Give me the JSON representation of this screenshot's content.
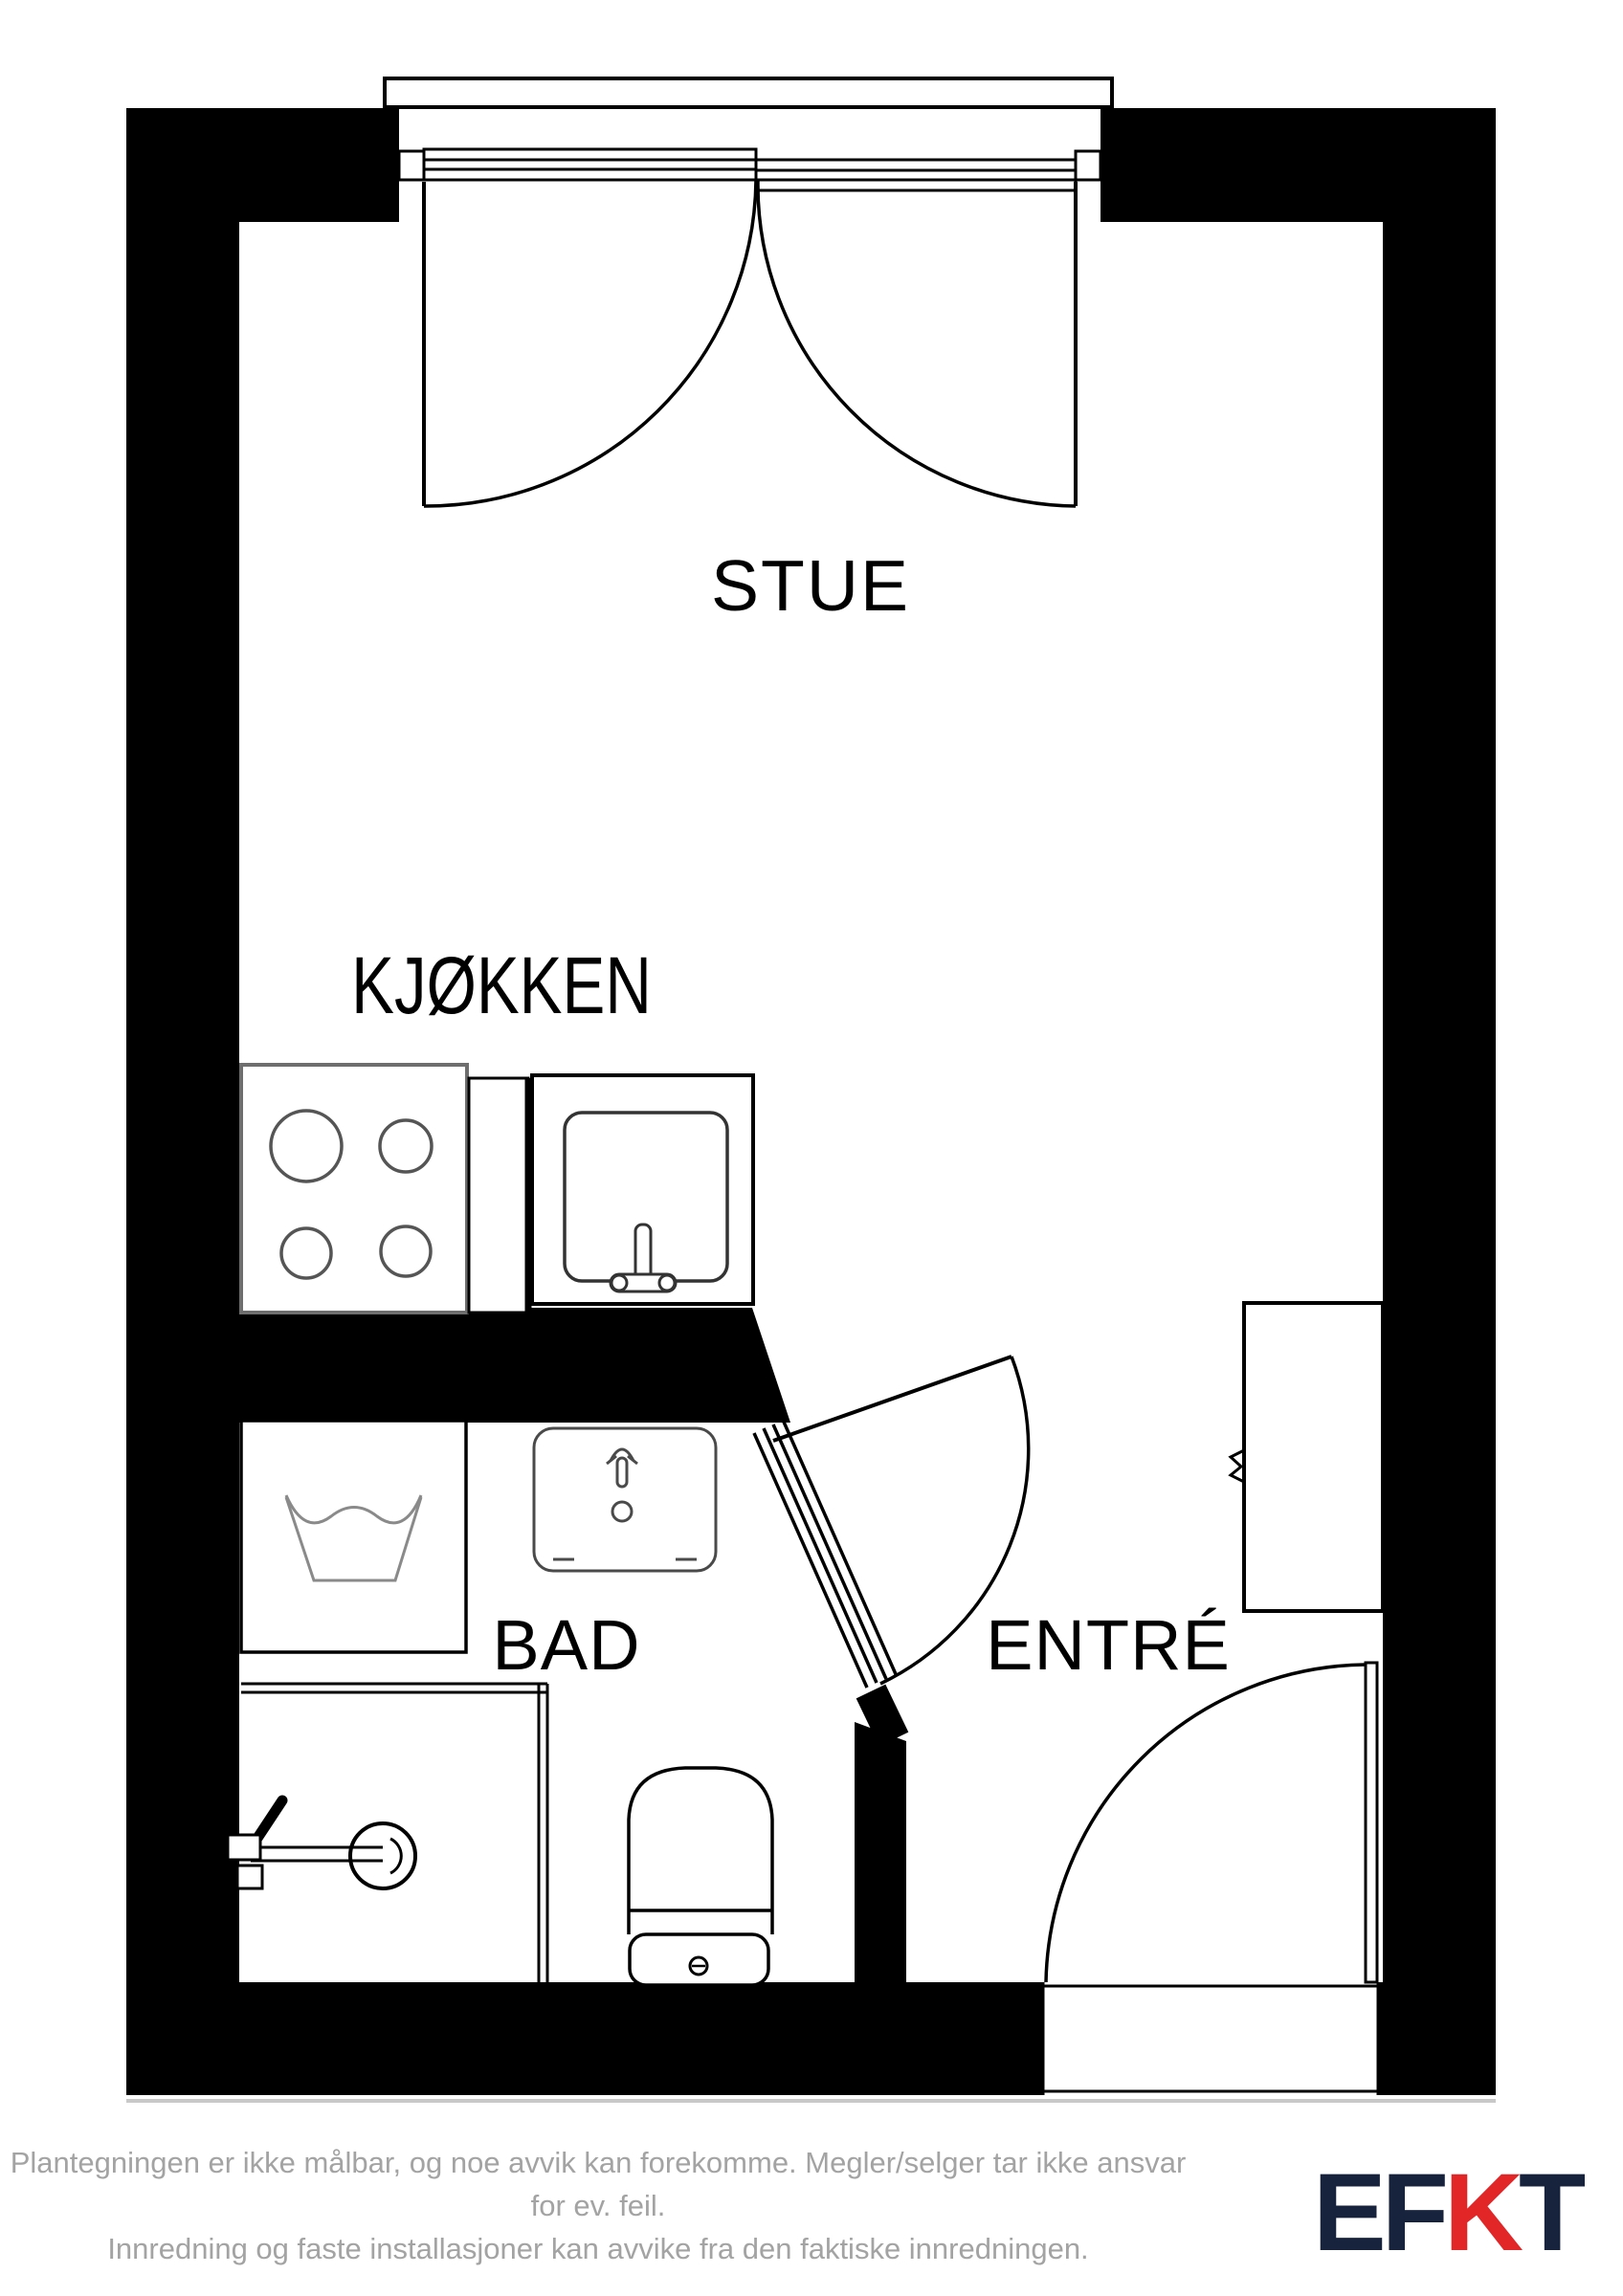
{
  "colors": {
    "wall_black": "#000000",
    "fixture_dark_gray": "#555555",
    "fixture_light_gray": "#8a8a8a",
    "under_wall_line_gray": "#c8c8c8",
    "disclaimer_gray": "#a3a3a3",
    "logo_dark_navy": "#17233c",
    "logo_red": "#e22628"
  },
  "rooms": {
    "living": {
      "label": "STUE"
    },
    "kitchen": {
      "label": "KJØKKEN"
    },
    "bath": {
      "label": "BAD"
    },
    "entry": {
      "label": "ENTRÉ"
    }
  },
  "fixtures": [
    "balcony-double-door",
    "kitchen-stove-4-burners",
    "kitchen-sink-counter",
    "washing-machine",
    "bathroom-sink",
    "shower",
    "toilet",
    "bathroom-door",
    "entrance-door",
    "wardrobe"
  ],
  "footer": {
    "line1": "Plantegningen er ikke målbar, og noe avvik kan forekomme. Megler/selger tar ikke ansvar for ev. feil.",
    "line2": "Innredning og faste installasjoner kan avvike fra den faktiske innredningen."
  },
  "logo": {
    "letters": [
      {
        "char": "E"
      },
      {
        "char": "F"
      },
      {
        "char": "K"
      },
      {
        "char": "T"
      }
    ]
  }
}
